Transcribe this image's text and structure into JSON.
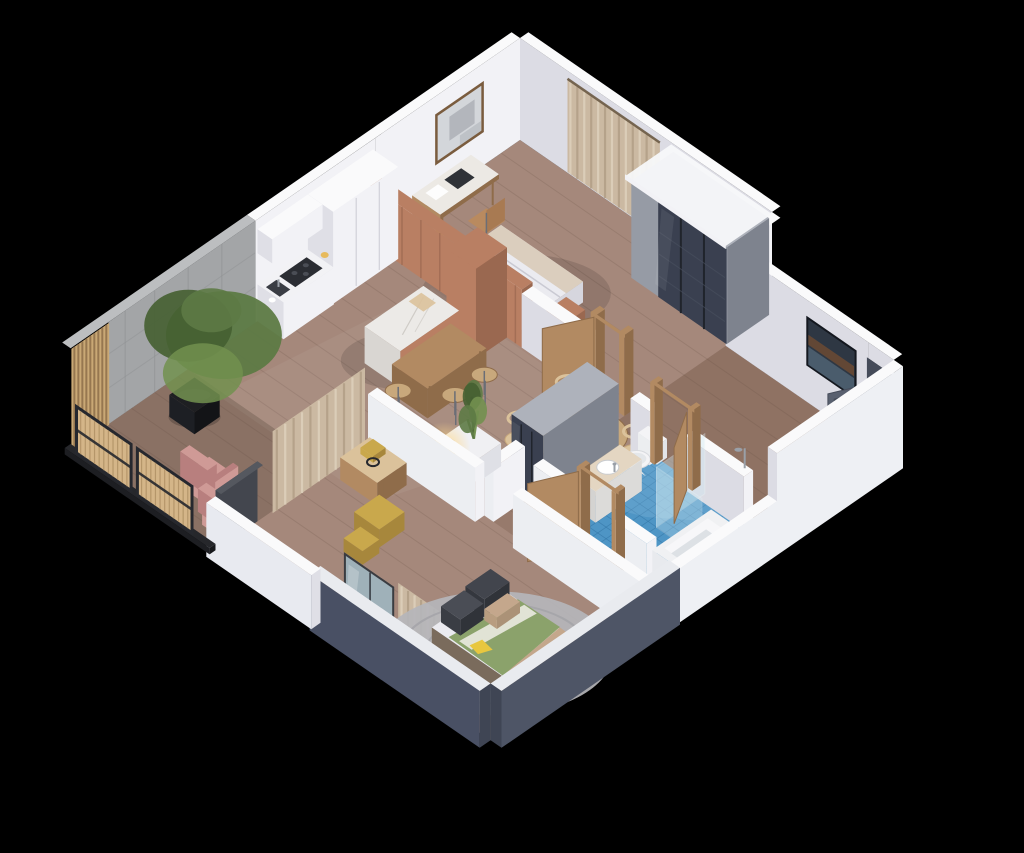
{
  "scene": {
    "label": "3D isometric cutaway rendering of a one-bedroom apartment floor plan on a black background",
    "background": "#000000"
  },
  "rooms": [
    {
      "name": "master-bedroom"
    },
    {
      "name": "walk-in-closet"
    },
    {
      "name": "kitchen"
    },
    {
      "name": "dining-area"
    },
    {
      "name": "living-area"
    },
    {
      "name": "hallway"
    },
    {
      "name": "bathroom"
    },
    {
      "name": "second-bedroom"
    },
    {
      "name": "balcony"
    }
  ],
  "furniture": [
    "double-bed",
    "desk",
    "desk-chair",
    "wall-art",
    "sliding-door-wardrobe",
    "curtains",
    "kitchen-cabinets",
    "cooktop",
    "kitchen-sink",
    "kitchen-island",
    "wood-dining-table",
    "bar-stools",
    "round-dining-table",
    "dining-chairs",
    "planter-box-plant",
    "potted-tree",
    "floor-lamp",
    "console-table",
    "brass-coffee-tables",
    "pink-armchairs",
    "rattan-screens",
    "bathroom-vanity",
    "toilet",
    "shower-glass",
    "bathtub",
    "bed-with-green-duvet",
    "round-rug",
    "mirror-wardrobe",
    "entry-door",
    "wooden-door-frames"
  ],
  "colors": {
    "bg": "#000000",
    "wallWhite": "#f2f2f6",
    "wallBright": "#eef0f4",
    "wallDim": "#dcdce4",
    "wallTop": "#fafafb",
    "wallCut": "#eceef2",
    "concrete": "#a3a5a7",
    "concreteDim": "#8f9194",
    "concreteTop": "#bcbec0",
    "slate": "#4e5566",
    "slateLit": "#495064",
    "slateDim": "#3f4554",
    "slatWood": "#c9a875",
    "slatDark": "#8a6b48",
    "rattan": "#d4b588",
    "rattanDark": "#a98a5e",
    "frameDark": "#26282e",
    "floorWood": "#a5887b",
    "floorHall": "#8d7162",
    "floorBalcony": "#8a7164",
    "plankLine": "#5f4a3e",
    "tile": "#4e95c5",
    "tileDark": "#2e6f9f",
    "tileLight": "#8fc0df",
    "terra": "#b97f63",
    "terraDim": "#9a6850",
    "wood": "#b28a62",
    "woodDim": "#8f6c4a",
    "woodLight": "#c8a87c",
    "woodPale": "#dbc29b",
    "marble": "#eceae7",
    "marbleDim": "#d9d6d2",
    "white": "#f2f2f5",
    "whiteDim": "#dfdfe6",
    "gray": "#969ba5",
    "grayDim": "#7e838e",
    "grayTop": "#aeb2bb",
    "glassDark": "#3a4050",
    "doorDark": "#59606f",
    "doorDarkDim": "#454b59",
    "glass": "#cfe9f2",
    "pink": "#cf9a96",
    "pinkDim": "#b87f7e",
    "green": "#5d7a45",
    "greenDark": "#455f31",
    "greenLight": "#72904f",
    "potBlack": "#1e1f22",
    "sofa": "#42454d",
    "sofaDim": "#303339",
    "mustard": "#c09038",
    "brass": "#c9a84c",
    "brassDim": "#a7873c",
    "bedWhite": "#ebebf0",
    "bedWhiteDim": "#d6d6de",
    "duvetGreen": "#8ba26b",
    "duvetTan": "#c4a78c",
    "accentYellow": "#e8c73f",
    "rug": "#b5b5ba",
    "rugRing": "#a2a2a8",
    "curtain": "#cbb9a2",
    "curtainDim": "#b29e86",
    "curtainLight": "#ded1bd",
    "lampGlow": "#ffd98c",
    "lampCore": "#fff3cf",
    "artLight": "#d3d6da",
    "artShape": "#999da4",
    "artFrame": "#7a5c3e",
    "paintDark": "#2e3743",
    "paintBrown": "#6b4a33",
    "paintBlue": "#5d7489",
    "metal": "#9aa0a8",
    "shadow": "#000000"
  }
}
